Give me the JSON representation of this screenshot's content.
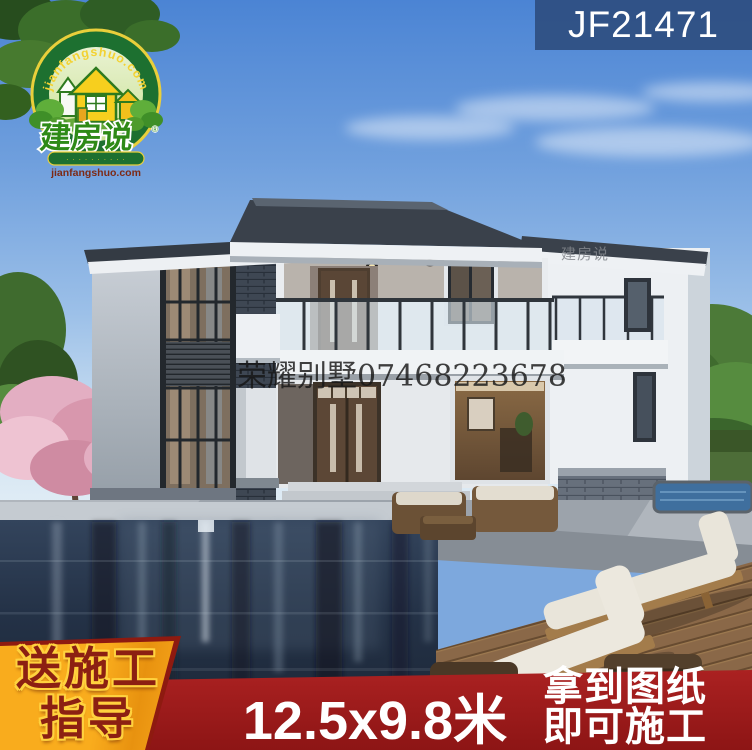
{
  "product_code": "JF21471",
  "logo": {
    "arc_text": "jianfangshuo.com",
    "brand": "建房说",
    "trademark": "®",
    "banner_text": "· · · · · · · · · ·",
    "website": "jianfangshuo.com"
  },
  "watermark": {
    "center": "荣耀别墅07468223678",
    "wall": "建房说"
  },
  "banners": {
    "gift_line1": "送施工",
    "gift_line2": "指导",
    "dimensions": "12.5x9.8米",
    "right_line1": "拿到图纸",
    "right_line2": "即可施工"
  },
  "colors": {
    "code_band_blue": "#2c4b7c",
    "bottom_band_red": "#a01c1c",
    "gift_box_orange": "#f6a51c",
    "gift_text_red": "#8c2012",
    "gift_outline_yellow": "#ffd23e",
    "logo_green": "#1d7030",
    "logo_yellow": "#f3d232",
    "sky_blue": "#4b84d4",
    "pool_navy": "#22304a",
    "roof_slate": "#3a414b"
  }
}
